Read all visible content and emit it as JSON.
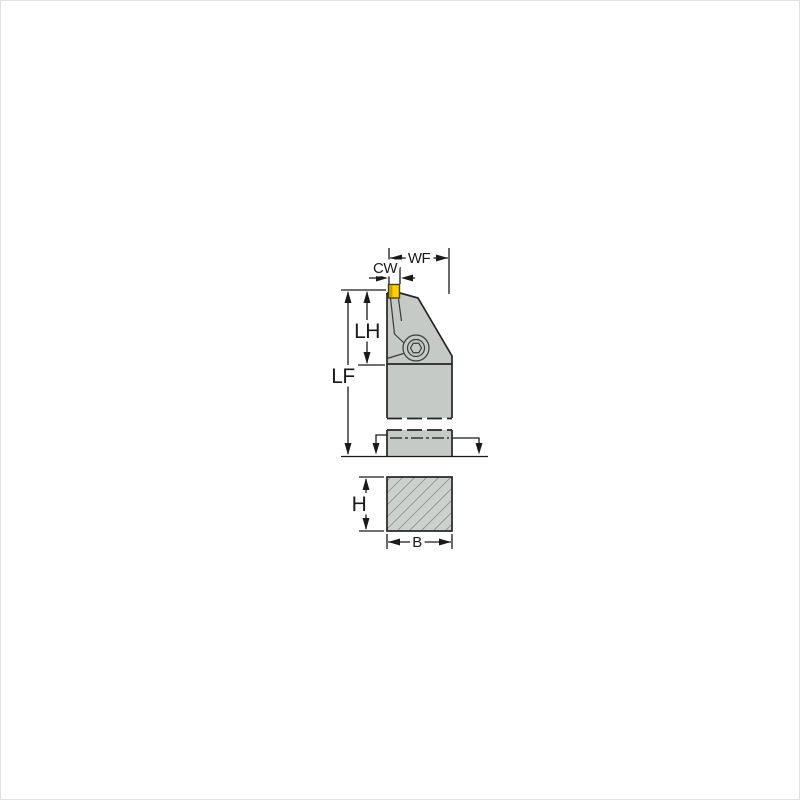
{
  "figure": {
    "kind": "tool-holder-dimension-drawing",
    "labels": {
      "wf": "WF",
      "cw": "CW",
      "lh": "LH",
      "lf": "LF",
      "h": "H",
      "b": "B"
    },
    "colors": {
      "body_fill": "#c5cac6",
      "section_fill": "#ccd1cd",
      "insert_fill": "#fdd000",
      "insert_shade": "#c2a300",
      "line": "#1a1a1a",
      "hatch": "#777c78"
    }
  }
}
